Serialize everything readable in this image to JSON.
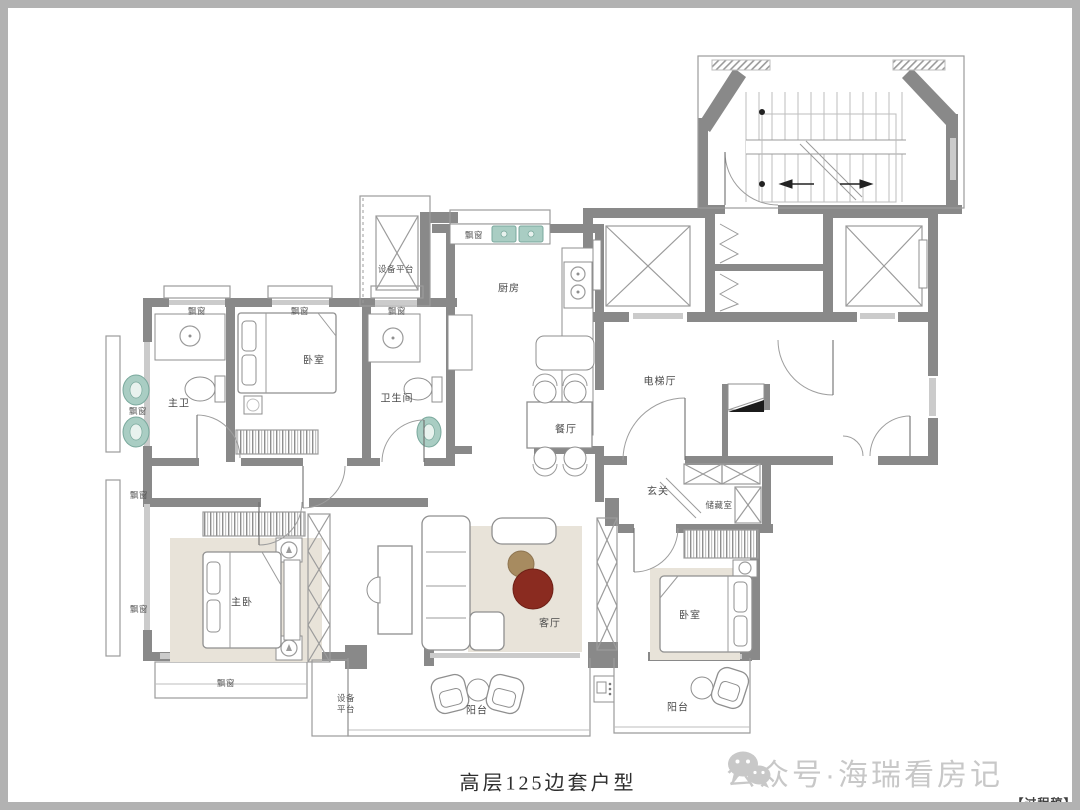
{
  "page": {
    "caption": "高层125边套户型",
    "watermark_text": "公众号·海瑞看房记",
    "draft_tag": "【过程稿】"
  },
  "labels": {
    "kitchen": "厨房",
    "master_bath": "主卫",
    "bedroom_top": "卧室",
    "bathroom": "卫生间",
    "dining": "餐厅",
    "elevator_hall": "电梯厅",
    "foyer": "玄关",
    "storage": "储藏室",
    "master_bedroom": "主卧",
    "living_room": "客厅",
    "bedroom_right": "卧室",
    "balcony_main": "阳台",
    "balcony_right": "阳台",
    "bay_window": "飘窗",
    "equipment_platform_top": "设备平台",
    "equipment_platform_bottom_line1": "设备",
    "equipment_platform_bottom_line2": "平台"
  },
  "colors": {
    "wall": "#898989",
    "window": "#cbcbcb",
    "fixture_teal": "#a9cdc3",
    "coffee_table_red": "#8a2b20",
    "side_table_tan": "#a78b60",
    "rug": "#e8e3d9",
    "watermark_gray": "#c8c8c8",
    "page_border": "#b2b2b2"
  }
}
